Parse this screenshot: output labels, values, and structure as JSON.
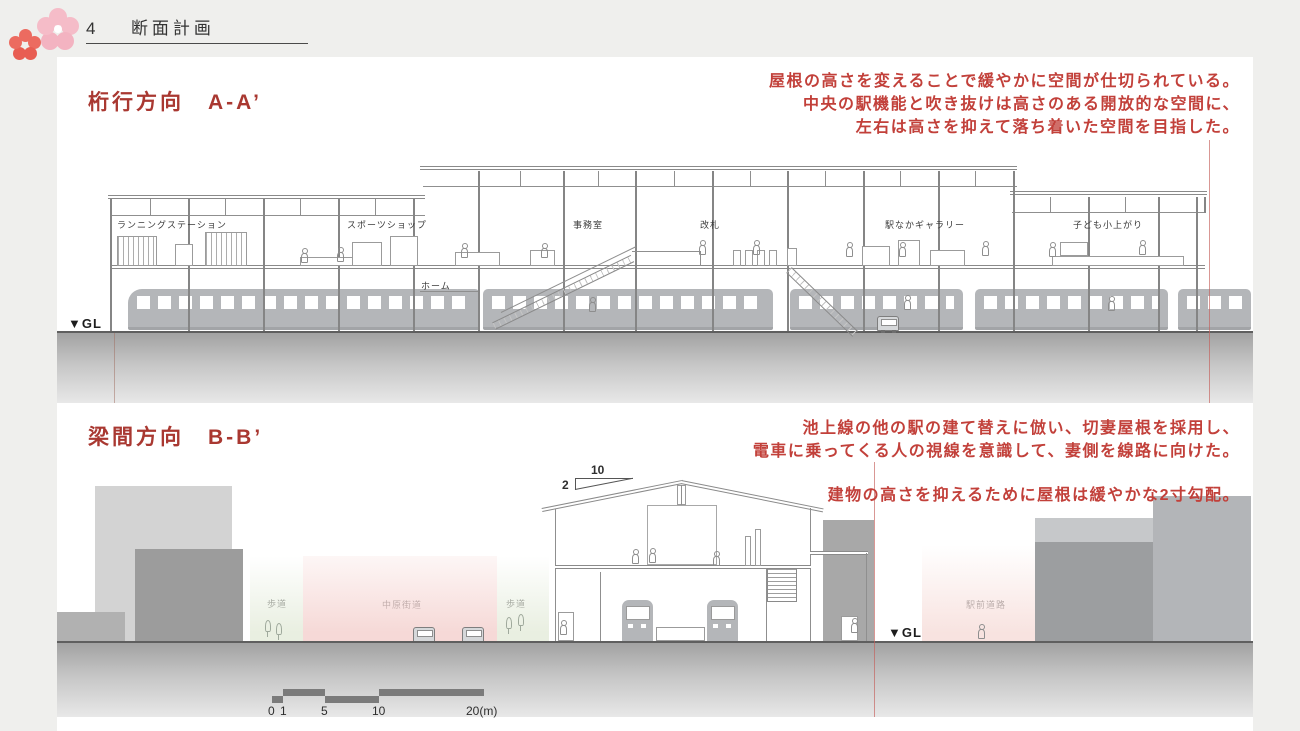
{
  "header": {
    "number": "4",
    "title": "断面計画"
  },
  "section_a": {
    "title": "桁行方向　A-A’",
    "annotation": [
      "屋根の高さを変えることで緩やかに空間が仕切られている。",
      "中央の駅機能と吹き抜けは高さのある開放的な空間に、",
      "左右は高さを抑えて落ち着いた空間を目指した。"
    ],
    "labels": {
      "running_station": "ランニングステーション",
      "sports_shop": "スポーツショップ",
      "office": "事務室",
      "ticket_gate": "改札",
      "gallery": "駅なかギャラリー",
      "kids_area": "子ども小上がり",
      "platform": "ホーム"
    },
    "gl": "▼GL"
  },
  "section_b": {
    "title": "梁間方向　B-B’",
    "annotation": [
      "池上線の他の駅の建て替えに倣い、切妻屋根を採用し、",
      "電車に乗ってくる人の視線を意識して、妻側を線路に向けた。"
    ],
    "annotation2": "建物の高さを抑えるために屋根は緩やかな2寸勾配。",
    "labels": {
      "sidewalk_left": "歩道",
      "nakahara_kaido": "中原街道",
      "sidewalk_right": "歩道",
      "ekimae_road": "駅前道路"
    },
    "slope": {
      "run": "10",
      "rise": "2"
    },
    "gl": "▼GL"
  },
  "scale_bar": {
    "t0": "0",
    "t1": "1",
    "t5": "5",
    "t10": "10",
    "t20": "20(m)"
  },
  "colors": {
    "title_red": "#a93831",
    "annotation_red": "#c2403a",
    "line_gray": "#8f8f8f",
    "train_gray": "#b4b6b9",
    "flower_pink": "#f5bcc8",
    "flower_red": "#ec6b60"
  }
}
